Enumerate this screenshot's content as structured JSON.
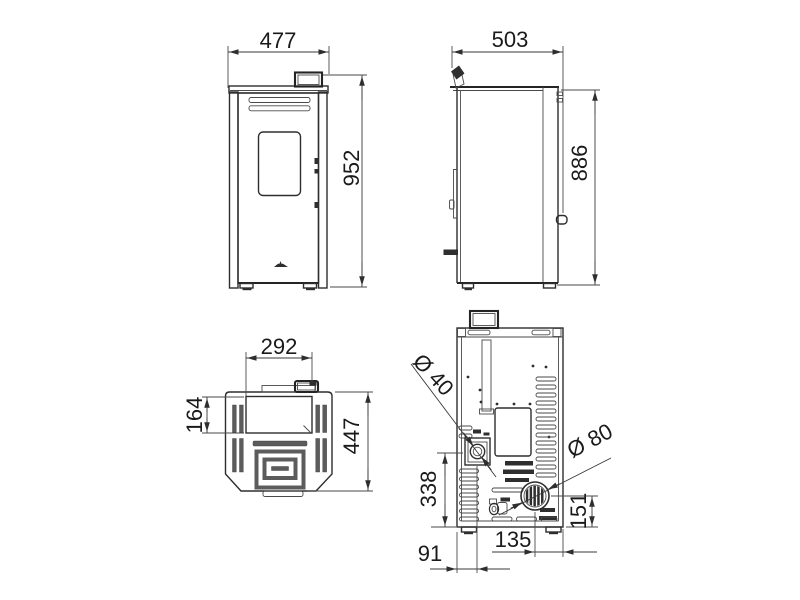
{
  "drawing": {
    "background": "#ffffff",
    "line_color": "#2e2e2e"
  },
  "views": {
    "front": {
      "dims": {
        "width": "477",
        "height": "952"
      }
    },
    "side": {
      "dims": {
        "depth": "503",
        "height": "886"
      }
    },
    "top": {
      "dims": {
        "hopper_width": "292",
        "hopper_depth": "164",
        "depth": "447"
      }
    },
    "back": {
      "dims": {
        "air_inlet_diameter": "Ø 40",
        "flue_diameter": "Ø 80",
        "inlet_height": "338",
        "flue_height": "151",
        "flue_offset": "135",
        "inlet_offset": "91"
      }
    }
  }
}
